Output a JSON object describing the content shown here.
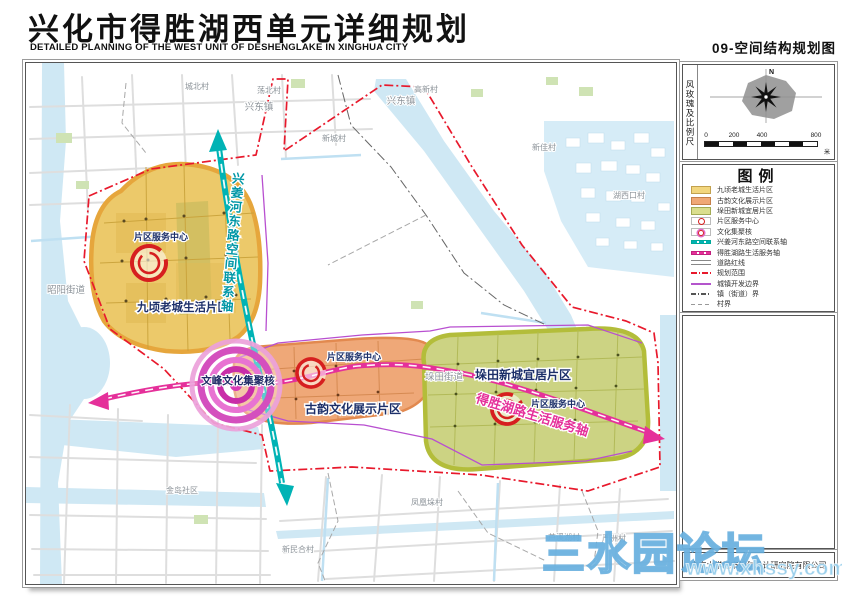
{
  "header": {
    "title_cn": "兴化市得胜湖西单元详细规划",
    "title_en": "DETAILED PLANNING OF THE WEST UNIT OF DESHENGLAKE IN XINGHUA CITY",
    "map_code": "09-空间结构规划图"
  },
  "sidebar": {
    "windrose_panel_label": "风玫瑰及比例尺",
    "north_label": "N",
    "scale": {
      "ticks": [
        "0",
        "200",
        "400",
        "800"
      ],
      "unit": "米"
    },
    "legend": {
      "title": "图例",
      "items": [
        {
          "label": "九顷老城生活片区",
          "swatch": "fill-yellow"
        },
        {
          "label": "古韵文化展示片区",
          "swatch": "fill-orange"
        },
        {
          "label": "垛田新城宜居片区",
          "swatch": "fill-green"
        },
        {
          "label": "片区服务中心",
          "swatch": "icon-service"
        },
        {
          "label": "文化集聚核",
          "swatch": "icon-core"
        },
        {
          "label": "兴姜河东路空间联系轴",
          "swatch": "line-teal"
        },
        {
          "label": "得胜湖路生活服务轴",
          "swatch": "line-magenta"
        },
        {
          "label": "道路红线",
          "swatch": "line-road"
        },
        {
          "label": "规划范围",
          "swatch": "line-reddash"
        },
        {
          "label": "城镇开发边界",
          "swatch": "line-purple"
        },
        {
          "label": "镇（街道）界",
          "swatch": "line-towndash"
        },
        {
          "label": "村界",
          "swatch": "line-villagedash"
        }
      ]
    },
    "publisher": "南京大学城市规划设计研究院有限公司"
  },
  "map": {
    "zones": {
      "jiuqing": {
        "name": "九顷老城生活片区",
        "color": "#ecc96a"
      },
      "guyun": {
        "name": "古韵文化展示片区",
        "color": "#efa878"
      },
      "duotian": {
        "name": "垛田新城宜居片区",
        "color": "#ccd383"
      }
    },
    "service_center_label": "片区服务中心",
    "core_label": "文峰文化集聚核",
    "axes": {
      "vertical": "兴姜河东路空间联系轴",
      "horizontal": "得胜湖路生活服务轴"
    },
    "places": [
      {
        "name": "城北村"
      },
      {
        "name": "荡北村"
      },
      {
        "name": "兴东镇"
      },
      {
        "name": "兴东镇"
      },
      {
        "name": "高新村"
      },
      {
        "name": "新城村"
      },
      {
        "name": "新佳村"
      },
      {
        "name": "湖西口村"
      },
      {
        "name": "昭阳街道"
      },
      {
        "name": "垛田街道"
      },
      {
        "name": "金岛社区"
      },
      {
        "name": "凤凰垛村"
      },
      {
        "name": "新民合村"
      },
      {
        "name": "芦溪湖村"
      },
      {
        "name": "严洲村"
      }
    ]
  },
  "watermark": {
    "line1": "三水园论坛",
    "line2": "www.xhssy.com.cn"
  },
  "colors": {
    "zone_yellow": "#ecc96a",
    "zone_orange": "#efa878",
    "zone_green": "#ccd383",
    "axis_teal": "#00b3b5",
    "axis_magenta": "#e5309a",
    "service_red": "#d61f1f",
    "boundary_red": "#e8192c",
    "dev_boundary_purple": "#b455cc"
  }
}
